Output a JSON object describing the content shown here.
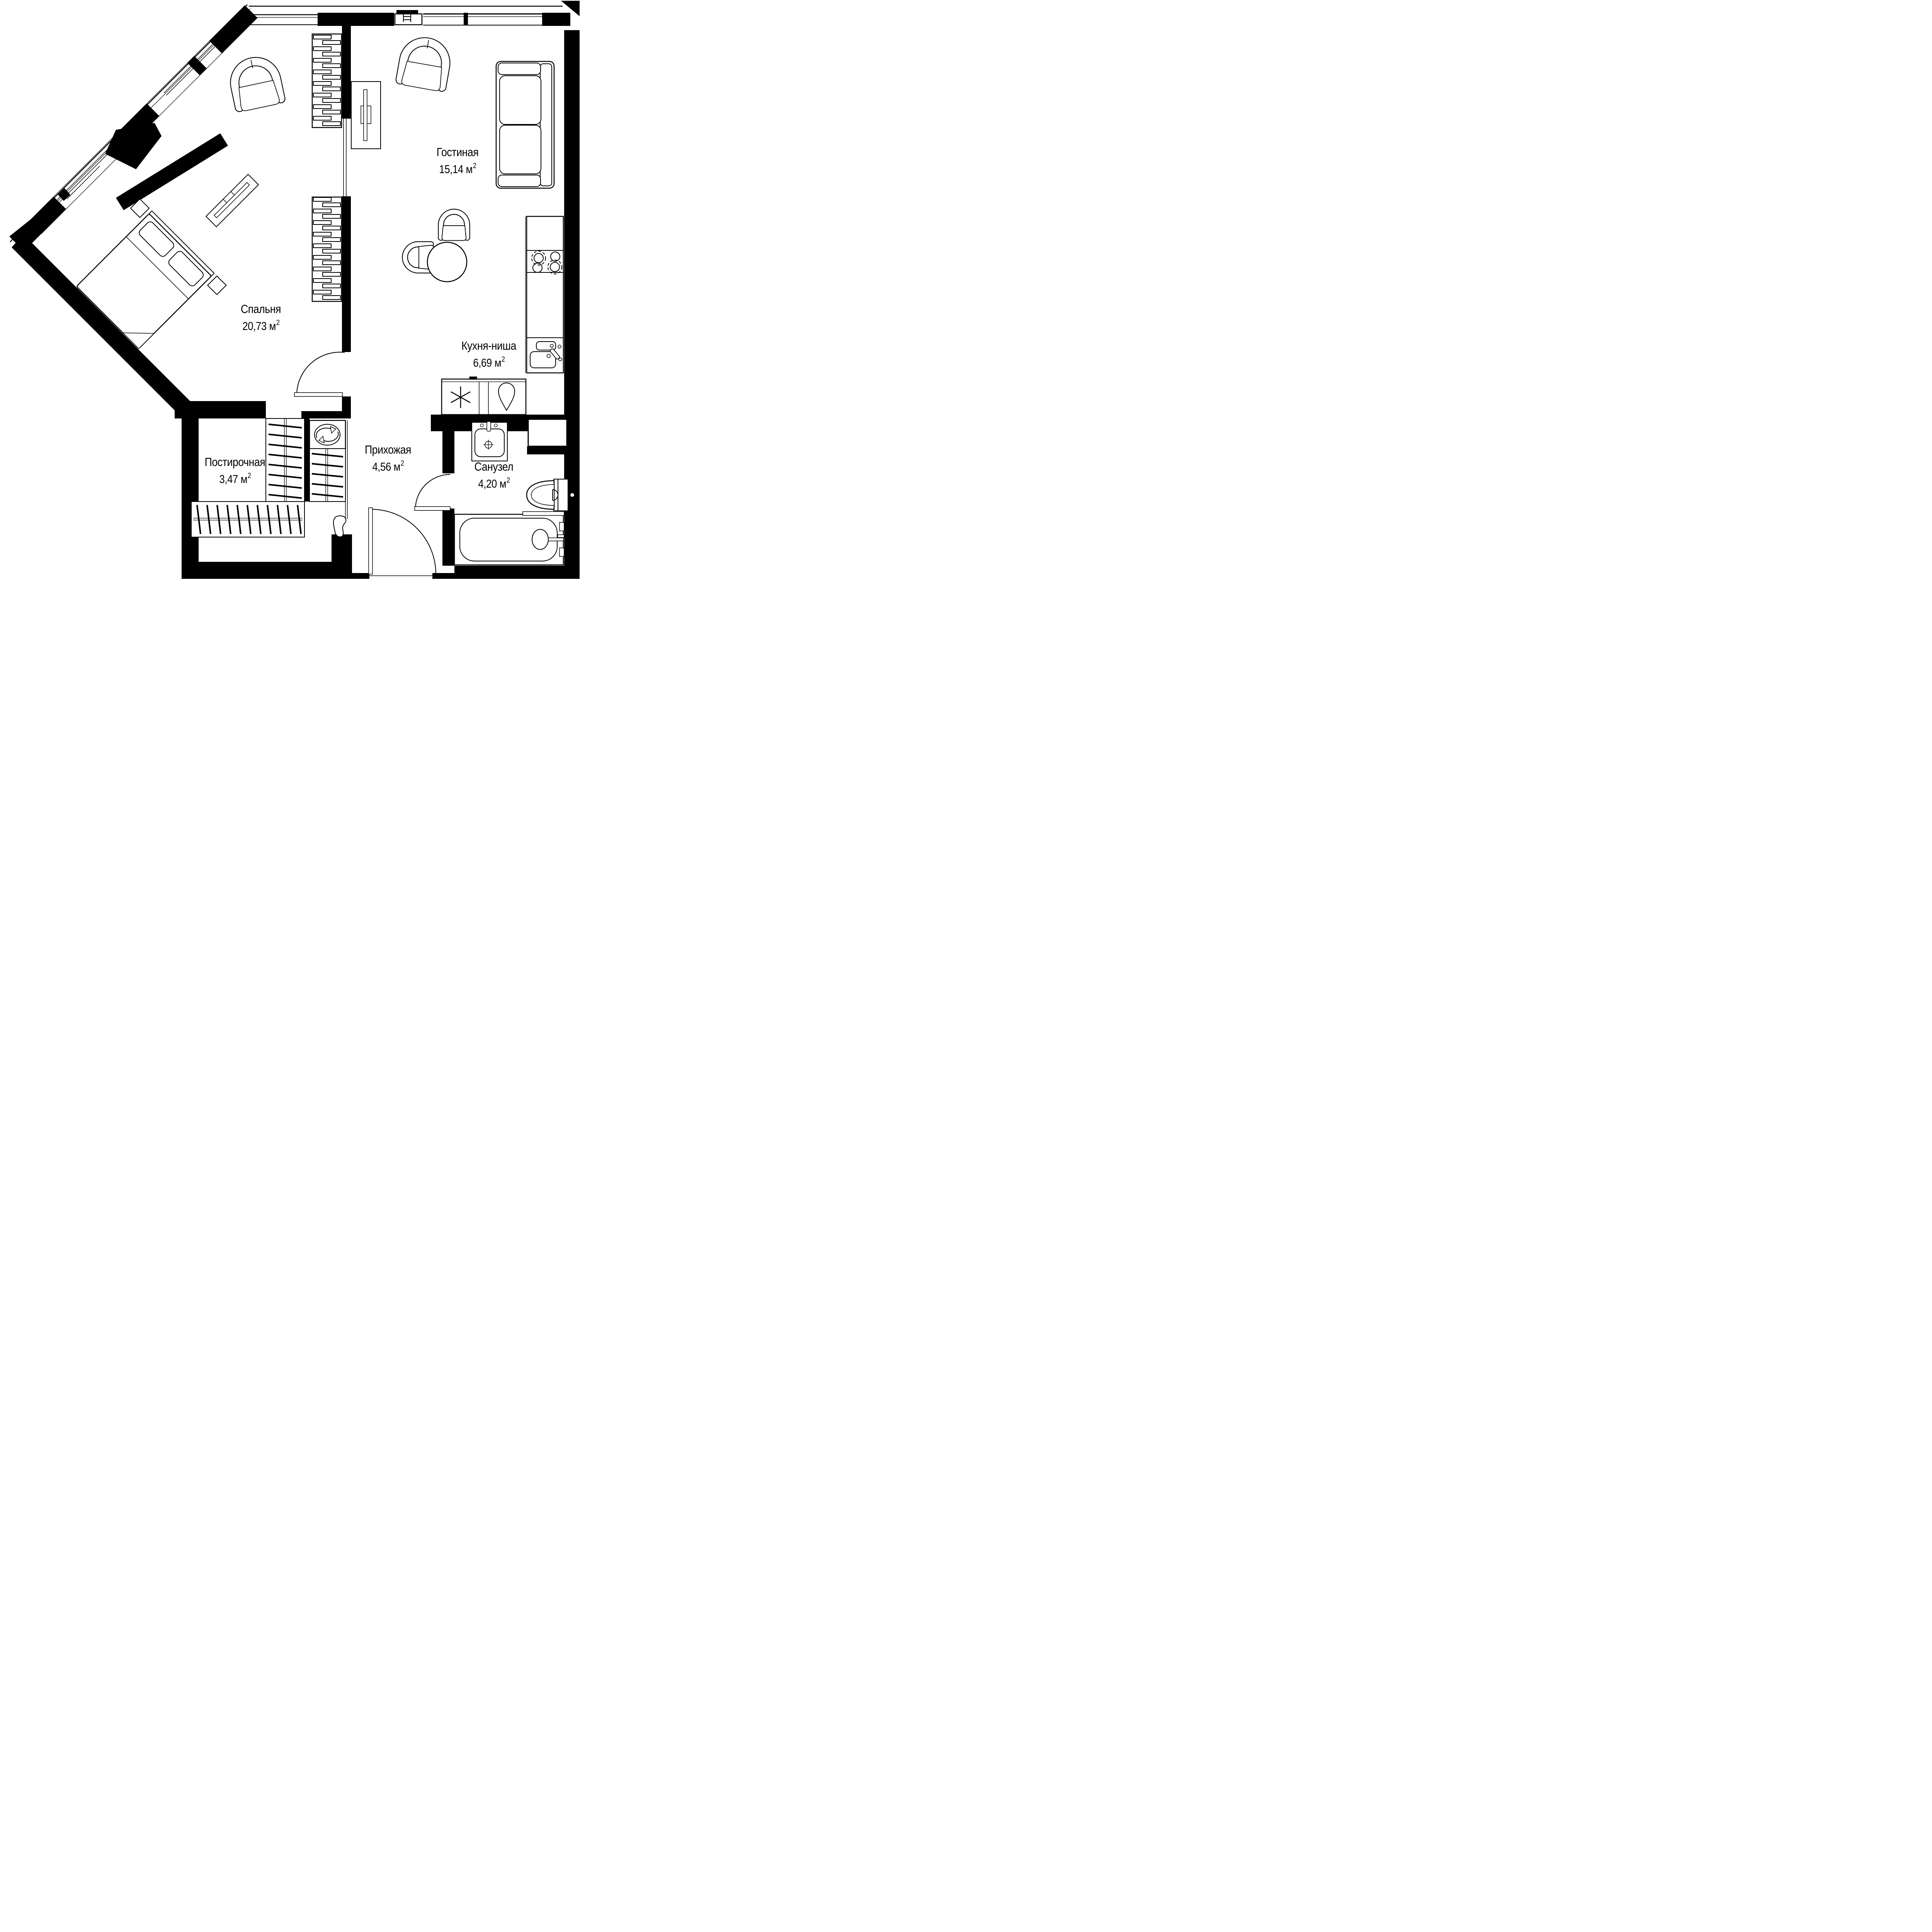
{
  "plan_type": "apartment-floor-plan",
  "unit": {
    "base": "м",
    "sup": "2"
  },
  "rooms": [
    {
      "key": "living",
      "name": "Гостиная",
      "area": "15,14"
    },
    {
      "key": "bedroom",
      "name": "Спальня",
      "area": "20,73"
    },
    {
      "key": "kitchen",
      "name": "Кухня-ниша",
      "area": "6,69"
    },
    {
      "key": "hallway",
      "name": "Прихожая",
      "area": "4,56"
    },
    {
      "key": "laundry",
      "name": "Постирочная",
      "area": "3,47"
    },
    {
      "key": "bathroom",
      "name": "Санузел",
      "area": "4,20"
    }
  ],
  "colors": {
    "walls": "#000000",
    "background": "#ffffff",
    "lines": "#000000"
  },
  "symbols": {
    "washing_machine": "circular-arrows",
    "fridge": "snowflake-asterisk",
    "water_point": "teardrop",
    "stove": "four-burners",
    "wardrobe": "rod-with-hangers",
    "shelving": "staggered-slats"
  }
}
